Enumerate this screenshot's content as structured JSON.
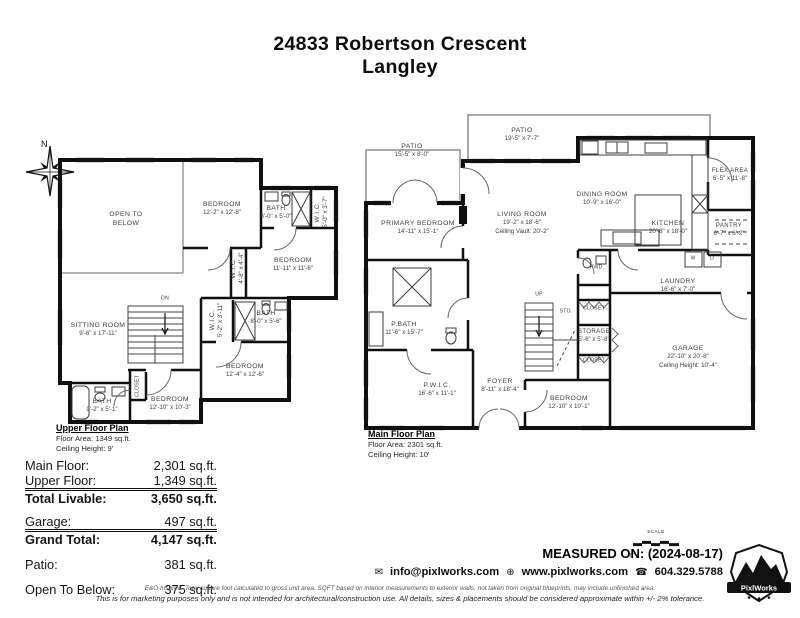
{
  "title": {
    "line1": "24833 Robertson Crescent",
    "line2": "Langley"
  },
  "compass": {
    "label": "N"
  },
  "upper_floor": {
    "plan_title": "Upper Floor Plan",
    "floor_area": "Floor Area: 1349 sq.ft.",
    "ceiling_height": "Ceiling Height: 9'",
    "rooms": {
      "open_below": {
        "name": "OPEN TO",
        "dims": "BELOW"
      },
      "bedroom_1": {
        "name": "BEDROOM",
        "dims": "12'-2\" x 12'-8\""
      },
      "bath_1": {
        "name": "BATH",
        "dims": "8'-0\" x 5'-0\""
      },
      "wic_1": {
        "name": "W.I.C.",
        "dims": "5'-0\" x 3'-7\""
      },
      "wic_2": {
        "name": "W.I.C.",
        "dims": "4'-8\" x 4'-4\""
      },
      "bedroom_2": {
        "name": "BEDROOM",
        "dims": "11'-11\" x 11'-6\""
      },
      "sitting": {
        "name": "SITTING ROOM",
        "dims": "9'-6\" x 17'-11\""
      },
      "stairs": {
        "name": "DN"
      },
      "wic_3": {
        "name": "W.I.C.",
        "dims": "5'-2\" x 3'-11\""
      },
      "bath_2": {
        "name": "BATH",
        "dims": "8'-0\" x 5'-6\""
      },
      "bedroom_3": {
        "name": "BEDROOM",
        "dims": "12'-4\" x 12'-6\""
      },
      "closet": {
        "name": "CLOSET"
      },
      "bath_3": {
        "name": "BATH",
        "dims": "9'-2\" x 5'-1\""
      },
      "bedroom_4": {
        "name": "BEDROOM",
        "dims": "12'-10\" x 10'-3\""
      }
    }
  },
  "main_floor": {
    "plan_title": "Main Floor Plan",
    "floor_area": "Floor Area: 2301 sq.ft.",
    "ceiling_height": "Ceiling Height: 10'",
    "rooms": {
      "patio_1": {
        "name": "PATIO",
        "dims": "15'-5\" x 8'-0\""
      },
      "patio_2": {
        "name": "PATIO",
        "dims": "19'-5\" x 7'-7\""
      },
      "primary_bedroom": {
        "name": "PRIMARY BEDROOM",
        "dims": "14'-11\" x 15'-1\""
      },
      "living": {
        "name": "LIVING ROOM",
        "dims": "19'-2\" x 18'-6\"",
        "extra": "Ceiling Vault: 20'-2\""
      },
      "dining": {
        "name": "DINING ROOM",
        "dims": "10'-9\" x 16'-0\""
      },
      "kitchen": {
        "name": "KITCHEN",
        "dims": "20'-8\" x 18'-0\""
      },
      "flex": {
        "name": "FLEX AREA",
        "dims": "6'-5\" x 11'-8\""
      },
      "pantry": {
        "name": "PANTRY",
        "dims": "6'-7\" x 6'-2\""
      },
      "pwd": {
        "name": "PWD."
      },
      "laundry": {
        "name": "LAUNDRY",
        "dims": "16'-6\" x 7'-0\""
      },
      "washer": {
        "name": "W"
      },
      "dryer": {
        "name": "D"
      },
      "p_bath": {
        "name": "P.BATH",
        "dims": "11'-6\" x 15'-7\""
      },
      "p_wic": {
        "name": "P.W.I.C.",
        "dims": "16'-6\" x 11'-1\""
      },
      "foyer": {
        "name": "FOYER",
        "dims": "8'-11\" x 18'-4\""
      },
      "stairs": {
        "name": "UP"
      },
      "sto": {
        "name": "STO."
      },
      "closet_a": {
        "name": "CLOSET"
      },
      "storage": {
        "name": "STORAGE",
        "dims": "5'-6\" x 5'-8\""
      },
      "closet_b": {
        "name": "CLOSET"
      },
      "bedroom_5": {
        "name": "BEDROOM",
        "dims": "12'-10\" x 10'-1\""
      },
      "garage": {
        "name": "GARAGE",
        "dims": "22'-10\" x 20'-8\"",
        "extra": "Ceiling Height: 10'-4\""
      }
    }
  },
  "summary": {
    "rows": [
      {
        "label": "Main Floor:",
        "value": "2,301 sq.ft."
      },
      {
        "label": "Upper Floor:",
        "value": "1,349 sq.ft."
      },
      {
        "label": "Total Livable:",
        "value": "3,650 sq.ft."
      },
      {
        "label": "Garage:",
        "value": "497 sq.ft."
      },
      {
        "label": "Grand Total:",
        "value": "4,147 sq.ft."
      },
      {
        "label": "Patio:",
        "value": "381 sq.ft."
      },
      {
        "label": "Open To Below:",
        "value": "375 sq.ft."
      }
    ]
  },
  "footer": {
    "scale_label": "SCALE",
    "scale_start": "0'",
    "scale_end": "5'",
    "measured_on": "MEASURED ON: (2024-08-17)",
    "email": "info@pixlworks.com",
    "website": "www.pixlworks.com",
    "phone": "604.329.5788",
    "logo_text": "PixlWorks",
    "disclaimer_1": "E&O Insured.  Total square foot calculated to gross unit area. SQFT based on interior measurements to exterior walls, not taken from original blueprints, may include unfinished area.",
    "disclaimer_2": "This is for marketing purposes only and is not intended for architectural/construction use.  All details, sizes & placements should be considered approximate within +/- 2%  tolerance."
  }
}
